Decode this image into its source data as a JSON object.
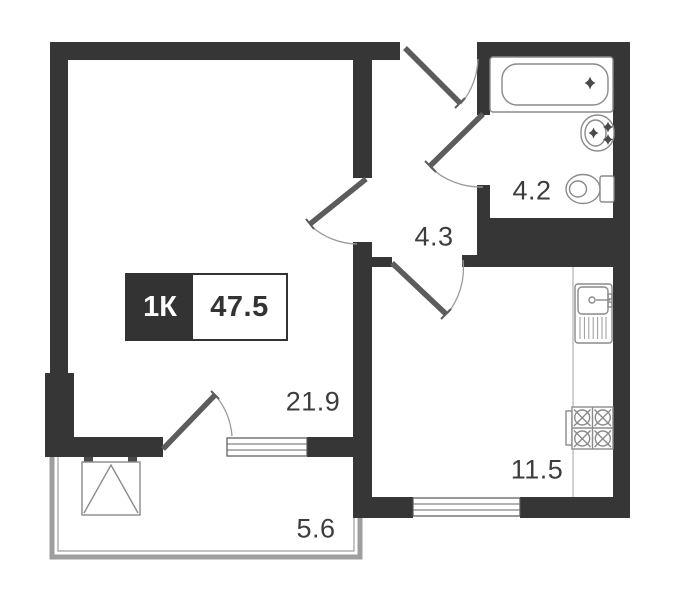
{
  "plan": {
    "title": "1K apartment floor plan",
    "type_box": {
      "type_label": "1К",
      "total_area": "47.5"
    },
    "rooms": {
      "living": {
        "area": "21.9"
      },
      "hallway": {
        "area": "4.3"
      },
      "bathroom": {
        "area": "4.2"
      },
      "kitchen": {
        "area": "11.5"
      },
      "balcony": {
        "area": "5.6"
      }
    },
    "fixtures": [
      "bathtub",
      "washbasin",
      "toilet",
      "kitchen-sink",
      "stove",
      "wardrobe"
    ]
  },
  "colors": {
    "wall": "#363636",
    "door": "#5c5c5c",
    "arc": "#9b9b9b",
    "fixture": "#8a8a8a",
    "balcony": "#9e9e9e",
    "label": "#3d3d3d",
    "background": "#ffffff",
    "accent": "#333333"
  }
}
